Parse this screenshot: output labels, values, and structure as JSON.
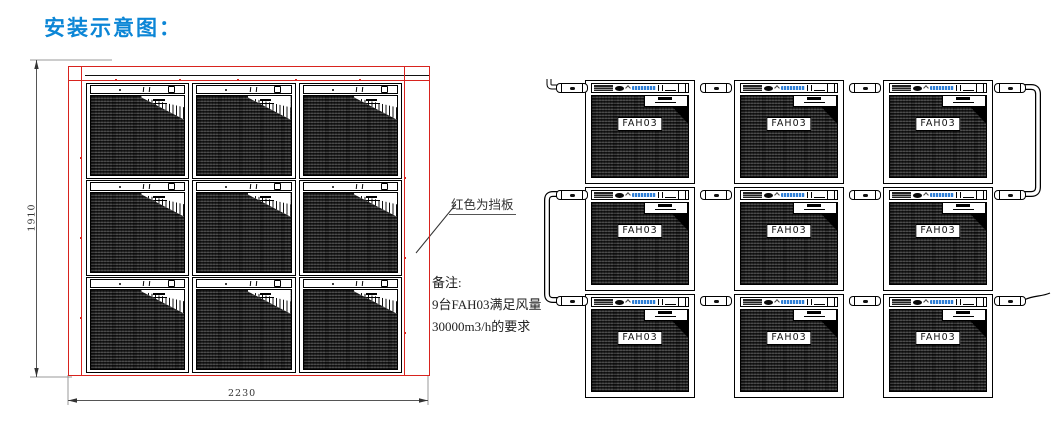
{
  "title": "安装示意图：",
  "front_view": {
    "width_dim": "2230",
    "height_dim": "1910",
    "baffle_label": "红色为挡板"
  },
  "notes": {
    "heading": "备注:",
    "lines": [
      "9台FAH03满足风量",
      "30000m3/h的要求"
    ]
  },
  "side_view": {
    "unit_label": "FAH03"
  },
  "colors": {
    "title_blue": "#0c86d6",
    "baffle_red": "#d8231e",
    "brand_blue": "#2f7fd6",
    "mesh_dark": "#3d3d3d"
  }
}
